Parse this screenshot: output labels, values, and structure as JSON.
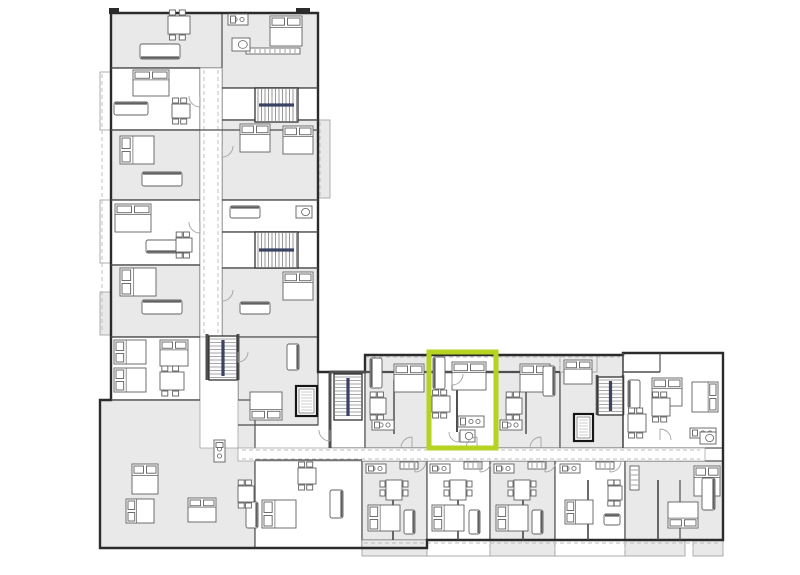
{
  "canvas": {
    "width": 800,
    "height": 575,
    "background": "#ffffff"
  },
  "colors": {
    "background": "#ffffff",
    "unit_gray": "#e9e9e9",
    "unit_white": "#ffffff",
    "balcony_gray": "#ededed",
    "wall_dark": "#2b2b2b",
    "wall_mid": "#4f4f4f",
    "wall_light": "#9a9a9a",
    "furniture": "#606060",
    "dash": "#bcbcbc",
    "stair_rail": "#3a4364",
    "door": "#a3a3a3",
    "highlight": "#b5d320"
  },
  "highlight": {
    "x": 429,
    "y": 352,
    "w": 67,
    "h": 96,
    "stroke_width": 5
  },
  "floorplan": {
    "outline": [
      [
        111,
        13
      ],
      [
        318,
        13
      ],
      [
        318,
        372
      ],
      [
        365,
        372
      ],
      [
        365,
        355
      ],
      [
        623,
        355
      ],
      [
        623,
        353
      ],
      [
        723,
        353
      ],
      [
        723,
        540
      ],
      [
        427,
        540
      ],
      [
        427,
        548
      ],
      [
        100,
        548
      ],
      [
        100,
        400
      ],
      [
        111,
        400
      ]
    ],
    "units": [
      [
        "g",
        111,
        13,
        207,
        55
      ],
      [
        "g",
        222,
        13,
        96,
        75
      ],
      [
        "w",
        111,
        68,
        89,
        62
      ],
      [
        "g",
        111,
        130,
        89,
        70
      ],
      [
        "w",
        111,
        200,
        89,
        65
      ],
      [
        "g",
        111,
        265,
        89,
        72
      ],
      [
        "w",
        222,
        88,
        96,
        32
      ],
      [
        "g",
        222,
        120,
        96,
        80
      ],
      [
        "w",
        222,
        200,
        96,
        32
      ],
      [
        "w",
        222,
        232,
        96,
        36
      ],
      [
        "g",
        222,
        268,
        96,
        69
      ],
      [
        "w",
        111,
        337,
        89,
        63
      ],
      [
        "g",
        238,
        337,
        80,
        88
      ],
      [
        "g",
        100,
        400,
        155,
        148
      ],
      [
        "w",
        255,
        460,
        107,
        88
      ],
      [
        "w",
        330,
        372,
        35,
        76
      ],
      [
        "g",
        365,
        355,
        64,
        93
      ],
      [
        "w",
        429,
        355,
        67,
        93
      ],
      [
        "g",
        496,
        355,
        64,
        93
      ],
      [
        "g",
        560,
        355,
        63,
        93
      ],
      [
        "w",
        623,
        353,
        100,
        95
      ],
      [
        "g",
        362,
        461,
        65,
        79
      ],
      [
        "w",
        427,
        461,
        63,
        79
      ],
      [
        "g",
        490,
        461,
        65,
        79
      ],
      [
        "w",
        555,
        461,
        70,
        79
      ],
      [
        "g",
        625,
        461,
        98,
        79
      ]
    ],
    "balconies": [
      [
        "w",
        100,
        72,
        11,
        58
      ],
      [
        "w",
        100,
        200,
        11,
        63
      ],
      [
        "g",
        100,
        292,
        11,
        43
      ],
      [
        "g",
        318,
        120,
        12,
        78
      ],
      [
        "g",
        365,
        355,
        64,
        17
      ],
      [
        "w",
        429,
        355,
        67,
        17
      ],
      [
        "g",
        496,
        355,
        64,
        17
      ],
      [
        "g",
        560,
        355,
        37,
        17
      ],
      [
        "g",
        362,
        540,
        65,
        16
      ],
      [
        "w",
        427,
        540,
        63,
        16
      ],
      [
        "g",
        490,
        540,
        65,
        16
      ],
      [
        "w",
        555,
        540,
        70,
        16
      ],
      [
        "g",
        625,
        540,
        60,
        16
      ],
      [
        "g",
        693,
        540,
        30,
        16
      ],
      [
        "d",
        109,
        8,
        10,
        6
      ],
      [
        "d",
        296,
        8,
        14,
        6
      ]
    ],
    "corridors": [
      [
        200,
        68,
        22,
        269
      ],
      [
        238,
        448,
        467,
        13
      ],
      [
        200,
        337,
        38,
        111
      ]
    ],
    "dashes": [
      [
        365,
        357,
        620,
        357
      ],
      [
        102,
        74,
        102,
        333
      ],
      [
        320,
        122,
        320,
        196
      ],
      [
        242,
        450,
        700,
        450
      ],
      [
        242,
        459,
        700,
        459
      ],
      [
        364,
        543,
        721,
        543
      ],
      [
        365,
        355,
        365,
        372
      ],
      [
        429,
        355,
        429,
        372
      ],
      [
        496,
        355,
        496,
        372
      ],
      [
        560,
        355,
        560,
        372
      ],
      [
        427,
        540,
        427,
        555
      ],
      [
        490,
        540,
        490,
        555
      ],
      [
        555,
        540,
        555,
        555
      ],
      [
        625,
        540,
        625,
        555
      ],
      [
        693,
        540,
        693,
        555
      ],
      [
        204,
        70,
        204,
        333
      ],
      [
        218,
        70,
        218,
        333
      ]
    ],
    "walls": [
      [
        365,
        372,
        429,
        372,
        2.2
      ],
      [
        496,
        372,
        560,
        372,
        2.2
      ],
      [
        429,
        372,
        457,
        372,
        2.6
      ],
      [
        470,
        372,
        496,
        372,
        2.6
      ],
      [
        457,
        374,
        457,
        432,
        2
      ],
      [
        394,
        380,
        394,
        434,
        1.5
      ],
      [
        526,
        380,
        526,
        434,
        1.5
      ],
      [
        458,
        480,
        458,
        540,
        1.7
      ],
      [
        393,
        480,
        393,
        540,
        1.7
      ],
      [
        523,
        480,
        523,
        540,
        1.7
      ],
      [
        588,
        480,
        588,
        540,
        1.7
      ],
      [
        658,
        480,
        658,
        540,
        1.7
      ],
      [
        111,
        68,
        200,
        68,
        1.3
      ],
      [
        111,
        130,
        318,
        130,
        1.3
      ],
      [
        111,
        200,
        200,
        200,
        1.3
      ],
      [
        111,
        265,
        200,
        265,
        1.3
      ],
      [
        222,
        88,
        318,
        88,
        1.3
      ],
      [
        222,
        120,
        318,
        120,
        1.3
      ],
      [
        222,
        200,
        318,
        200,
        1.3
      ],
      [
        222,
        232,
        318,
        232,
        1.3
      ],
      [
        222,
        268,
        318,
        268,
        1.3
      ],
      [
        111,
        337,
        200,
        337,
        1.3
      ],
      [
        238,
        425,
        318,
        425,
        1.3
      ],
      [
        111,
        400,
        200,
        400,
        1.3
      ],
      [
        255,
        460,
        362,
        460,
        1.3
      ],
      [
        623,
        372,
        660,
        372,
        1.5
      ],
      [
        623,
        353,
        623,
        448,
        1.5
      ],
      [
        330,
        372,
        365,
        372,
        3
      ],
      [
        330,
        372,
        330,
        448,
        3
      ],
      [
        207,
        334,
        207,
        380,
        3
      ],
      [
        238,
        334,
        238,
        380,
        3
      ],
      [
        597,
        375,
        597,
        415,
        2.6
      ],
      [
        623,
        375,
        623,
        415,
        2.6
      ],
      [
        660,
        353,
        660,
        372,
        1.2
      ],
      [
        680,
        480,
        680,
        540,
        1.2
      ]
    ],
    "stairs": [
      [
        255,
        88,
        43,
        34,
        "h"
      ],
      [
        255,
        232,
        43,
        36,
        "h"
      ],
      [
        209,
        336,
        28,
        44,
        "v"
      ],
      [
        334,
        374,
        28,
        46,
        "v"
      ],
      [
        598,
        377,
        25,
        38,
        "v"
      ]
    ],
    "elevators": [
      [
        296,
        386,
        21,
        30
      ],
      [
        574,
        414,
        19,
        27
      ]
    ],
    "beds": [
      [
        "n",
        270,
        16,
        32,
        30
      ],
      [
        "n",
        133,
        70,
        36,
        26
      ],
      [
        "w",
        120,
        136,
        34,
        28
      ],
      [
        "n",
        240,
        124,
        30,
        28
      ],
      [
        "n",
        283,
        126,
        30,
        28
      ],
      [
        "n",
        115,
        204,
        36,
        28
      ],
      [
        "w",
        120,
        268,
        36,
        28
      ],
      [
        "n",
        283,
        272,
        30,
        28
      ],
      [
        "w",
        114,
        340,
        32,
        24
      ],
      [
        "w",
        114,
        368,
        32,
        24
      ],
      [
        "n",
        160,
        340,
        28,
        26
      ],
      [
        "s",
        250,
        392,
        32,
        28
      ],
      [
        "n",
        132,
        464,
        26,
        30
      ],
      [
        "w",
        126,
        499,
        28,
        24
      ],
      [
        "n",
        188,
        498,
        28,
        24
      ],
      [
        "w",
        262,
        500,
        34,
        28
      ],
      [
        "w",
        368,
        505,
        32,
        26
      ],
      [
        "w",
        432,
        505,
        32,
        26
      ],
      [
        "w",
        496,
        505,
        32,
        26
      ],
      [
        "w",
        565,
        500,
        28,
        24
      ],
      [
        "s",
        668,
        502,
        30,
        26
      ],
      [
        "n",
        694,
        466,
        26,
        30
      ],
      [
        "n",
        394,
        364,
        30,
        28
      ],
      [
        "n",
        452,
        362,
        34,
        28
      ],
      [
        "n",
        520,
        364,
        30,
        28
      ],
      [
        "n",
        564,
        360,
        28,
        24
      ],
      [
        "n",
        652,
        378,
        30,
        28
      ],
      [
        "e",
        692,
        382,
        26,
        30
      ]
    ],
    "sofas": [
      [
        "s",
        140,
        44,
        40,
        15
      ],
      [
        "n",
        114,
        102,
        34,
        13
      ],
      [
        "n",
        142,
        172,
        40,
        14
      ],
      [
        "s",
        146,
        240,
        38,
        13
      ],
      [
        "n",
        142,
        300,
        40,
        14
      ],
      [
        "n",
        230,
        206,
        30,
        12
      ],
      [
        "n",
        240,
        302,
        30,
        12
      ],
      [
        "e",
        287,
        344,
        12,
        26
      ],
      [
        "e",
        246,
        502,
        12,
        26
      ],
      [
        "e",
        330,
        490,
        13,
        28
      ],
      [
        "w",
        370,
        358,
        12,
        30
      ],
      [
        "w",
        433,
        357,
        12,
        32
      ],
      [
        "e",
        543,
        366,
        12,
        30
      ],
      [
        "e",
        404,
        510,
        11,
        24
      ],
      [
        "e",
        469,
        510,
        11,
        24
      ],
      [
        "e",
        532,
        510,
        11,
        24
      ],
      [
        "n",
        604,
        514,
        16,
        11
      ],
      [
        "e",
        702,
        478,
        13,
        32
      ],
      [
        "w",
        628,
        380,
        12,
        28
      ]
    ],
    "tables": [
      [
        168,
        16,
        22,
        18
      ],
      [
        172,
        104,
        18,
        14
      ],
      [
        176,
        238,
        16,
        14
      ],
      [
        238,
        486,
        16,
        16
      ],
      [
        298,
        468,
        18,
        16
      ],
      [
        160,
        372,
        24,
        18
      ],
      [
        386,
        480,
        16,
        20
      ],
      [
        450,
        480,
        16,
        20
      ],
      [
        514,
        480,
        16,
        20
      ],
      [
        608,
        486,
        14,
        14
      ],
      [
        370,
        398,
        16,
        16
      ],
      [
        432,
        396,
        18,
        16
      ],
      [
        506,
        398,
        16,
        16
      ],
      [
        628,
        414,
        18,
        18
      ],
      [
        652,
        398,
        18,
        18
      ]
    ],
    "kitchens": [
      [
        228,
        14,
        20,
        11
      ],
      [
        458,
        416,
        26,
        11
      ],
      [
        372,
        420,
        22,
        10
      ],
      [
        500,
        420,
        22,
        10
      ],
      [
        366,
        464,
        20,
        9
      ],
      [
        430,
        464,
        20,
        9
      ],
      [
        494,
        464,
        20,
        9
      ],
      [
        560,
        464,
        20,
        9
      ],
      [
        214,
        440,
        11,
        22
      ],
      [
        690,
        428,
        26,
        10
      ]
    ],
    "wardrobes": [
      [
        400,
        462,
        18,
        7
      ],
      [
        464,
        462,
        18,
        7
      ],
      [
        528,
        462,
        18,
        7
      ],
      [
        596,
        462,
        18,
        7
      ],
      [
        246,
        48,
        54,
        6
      ],
      [
        630,
        466,
        9,
        24
      ]
    ],
    "baths": [
      [
        232,
        38,
        18,
        13
      ],
      [
        296,
        206,
        16,
        12
      ],
      [
        460,
        430,
        15,
        12
      ],
      [
        700,
        432,
        16,
        12
      ]
    ],
    "doors": [
      [
        "se",
        415,
        461,
        11
      ],
      [
        "se",
        480,
        461,
        11
      ],
      [
        "se",
        545,
        461,
        11
      ],
      [
        "se",
        610,
        461,
        11
      ],
      [
        "nw",
        412,
        448,
        11
      ],
      [
        "nw",
        477,
        448,
        11
      ],
      [
        "nw",
        541,
        448,
        11
      ],
      [
        "sw",
        459,
        432,
        10
      ],
      [
        "se",
        452,
        374,
        11
      ],
      [
        "sw",
        200,
        96,
        11
      ],
      [
        "se",
        222,
        146,
        11
      ],
      [
        "sw",
        200,
        222,
        11
      ],
      [
        "se",
        222,
        290,
        11
      ],
      [
        "ne",
        660,
        440,
        11
      ],
      [
        "se",
        238,
        352,
        10
      ],
      [
        "sw",
        330,
        430,
        11
      ]
    ]
  }
}
